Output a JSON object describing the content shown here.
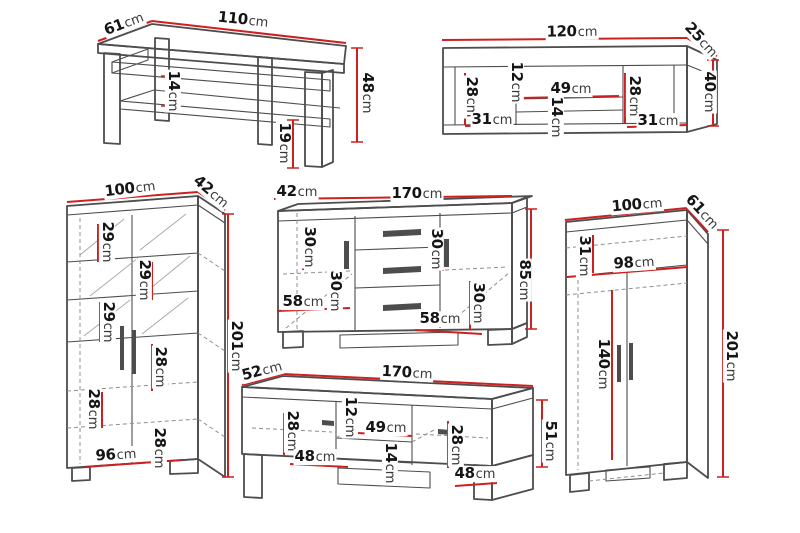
{
  "unit": "cm",
  "colors": {
    "dimension": "#cc2121",
    "outline": "#4d4d4d",
    "hidden": "#8f8f8f",
    "background": "#ffffff"
  },
  "furniture": {
    "coffee_table": {
      "dims": {
        "width": "110",
        "depth": "61",
        "height": "48",
        "shelf_gap": "14",
        "leg_height": "19"
      }
    },
    "wall_shelf": {
      "dims": {
        "width": "120",
        "depth": "25",
        "height": "40",
        "left_height": "28",
        "niche_top_height": "12",
        "niche_width": "49",
        "niche_bottom_height": "14",
        "right_height": "28",
        "left_width": "31",
        "right_width": "31"
      }
    },
    "display_cabinet": {
      "dims": {
        "width": "100",
        "depth": "42",
        "height": "201",
        "gap1": "29",
        "gap2": "29",
        "gap3": "29",
        "gap4": "28",
        "gap5": "28",
        "gap6": "28",
        "inner_width": "96"
      }
    },
    "sideboard": {
      "dims": {
        "depth": "42",
        "width": "170",
        "height": "85",
        "left_top": "30",
        "right_top": "30",
        "left_bottom": "30",
        "right_bottom": "30",
        "left_door_width": "58",
        "right_door_width": "58"
      }
    },
    "wardrobe": {
      "dims": {
        "width": "100",
        "depth": "61",
        "height": "201",
        "top_height": "31",
        "inner_width": "98",
        "door_height": "140"
      }
    },
    "tv_stand": {
      "dims": {
        "depth": "52",
        "width": "170",
        "height": "51",
        "left_height": "28",
        "niche_top_height": "12",
        "niche_width": "49",
        "niche_bottom_height": "14",
        "right_height": "28",
        "left_door_width": "48",
        "right_door_width": "48"
      }
    }
  }
}
